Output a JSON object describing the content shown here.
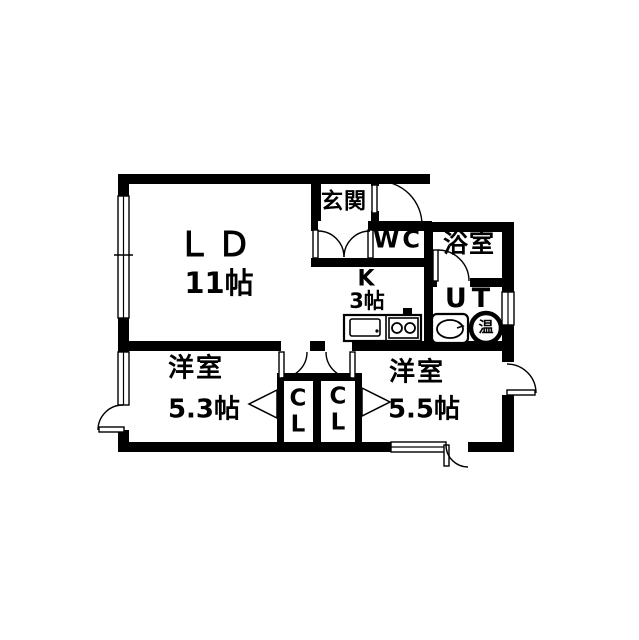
{
  "rooms": {
    "ld": {
      "name": "ＬＤ",
      "size": "11帖"
    },
    "kitchen": {
      "name": "K",
      "size": "3帖"
    },
    "genkan": {
      "name": "玄関"
    },
    "wc": {
      "name": "WC"
    },
    "bathroom": {
      "name": "浴室"
    },
    "utility": {
      "name": "UT"
    },
    "bedroom_left": {
      "name": "洋室",
      "size": "5.3帖"
    },
    "bedroom_right": {
      "name": "洋室",
      "size": "5.5帖"
    },
    "closet_left": {
      "name": "C\nL"
    },
    "closet_right": {
      "name": "C\nL"
    }
  },
  "fixtures": {
    "water_heater_label": "温"
  },
  "colors": {
    "wall": "#000000",
    "floor": "#ffffff"
  }
}
